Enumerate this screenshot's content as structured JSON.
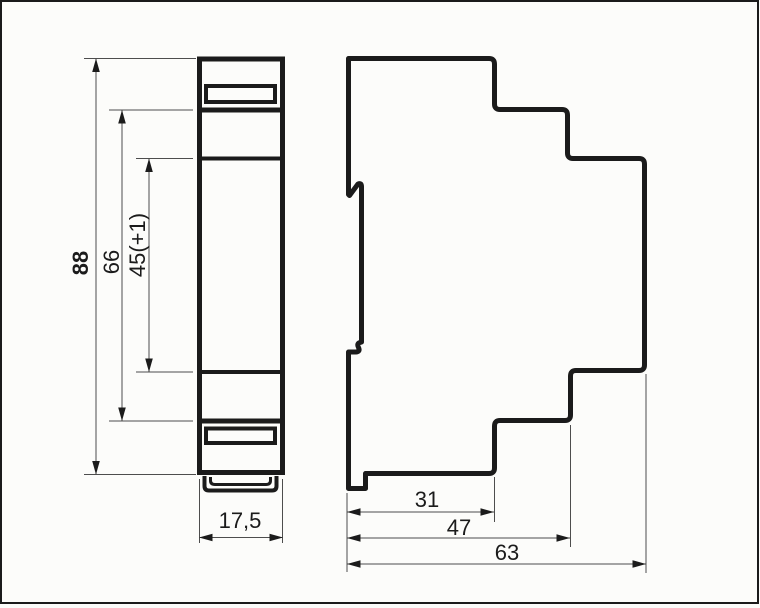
{
  "drawing": {
    "kind": "technical-dimension-drawing",
    "views": [
      "front-view",
      "side-view"
    ]
  },
  "colors": {
    "outline": "#1b1b1b",
    "thin_line": "#4d4d4d",
    "background": "#fcfcfa"
  },
  "dimensions": {
    "overall_height": "88",
    "upper_section_height": "66",
    "module_height": "45(+1)",
    "module_width": "17,5",
    "rail_depth": "31",
    "mid_depth": "47",
    "overall_depth": "63"
  }
}
